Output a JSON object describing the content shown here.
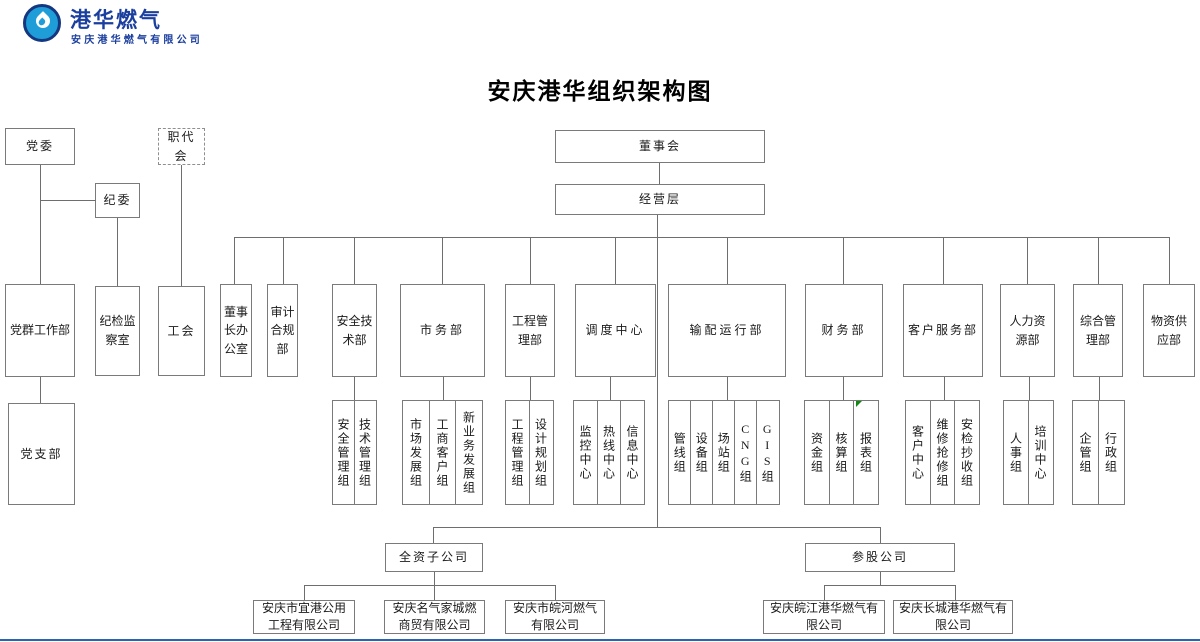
{
  "colors": {
    "line": "#6e6e6e",
    "box_border": "#7a7a7a",
    "logo_blue": "#1f9dd9",
    "logo_navy": "#1b3f9e",
    "marker_green": "#128a12",
    "bottom_rule_blue": "#2b62b4"
  },
  "logo": {
    "brand": "港华燃气",
    "company": "安庆港华燃气有限公司"
  },
  "title": "安庆港华组织架构图",
  "governance": {
    "party_committee": "党委",
    "discipline_committee": "纪委",
    "workers_congress": "职代会",
    "board": "董事会",
    "management": "经营层"
  },
  "departments": [
    {
      "label": "党群工作部",
      "children": [
        "党支部"
      ]
    },
    {
      "label": "纪检监察室",
      "children": []
    },
    {
      "label": "工会",
      "children": []
    },
    {
      "label": "董事长办公室",
      "children": []
    },
    {
      "label": "审计合规部",
      "children": []
    },
    {
      "label": "安全技术部",
      "children": [
        "安全管理组",
        "技术管理组"
      ]
    },
    {
      "label": "市务部",
      "children": [
        "市场发展组",
        "工商客户组",
        "新业务发展组"
      ]
    },
    {
      "label": "工程管理部",
      "children": [
        "工程管理组",
        "设计规划组"
      ]
    },
    {
      "label": "调度中心",
      "children": [
        "监控中心",
        "热线中心",
        "信息中心"
      ]
    },
    {
      "label": "输配运行部",
      "children": [
        "管线组",
        "设备组",
        "场站组",
        "CNG组",
        "GIS组"
      ]
    },
    {
      "label": "财务部",
      "children": [
        "资金组",
        "核算组",
        "报表组"
      ]
    },
    {
      "label": "客户服务部",
      "children": [
        "客户中心",
        "维修抢修组",
        "安检抄收组"
      ]
    },
    {
      "label": "人力资源部",
      "children": [
        "人事组",
        "培训中心"
      ]
    },
    {
      "label": "综合管理部",
      "children": [
        "企管组",
        "行政组"
      ]
    },
    {
      "label": "物资供应部",
      "children": []
    }
  ],
  "subsidiaries": {
    "wholly_owned": {
      "label": "全资子公司",
      "companies": [
        "安庆市宜港公用工程有限公司",
        "安庆名气家城燃商贸有限公司",
        "安庆市皖河燃气有限公司"
      ]
    },
    "equity": {
      "label": "参股公司",
      "companies": [
        "安庆皖江港华燃气有限公司",
        "安庆长城港华燃气有限公司"
      ]
    }
  }
}
